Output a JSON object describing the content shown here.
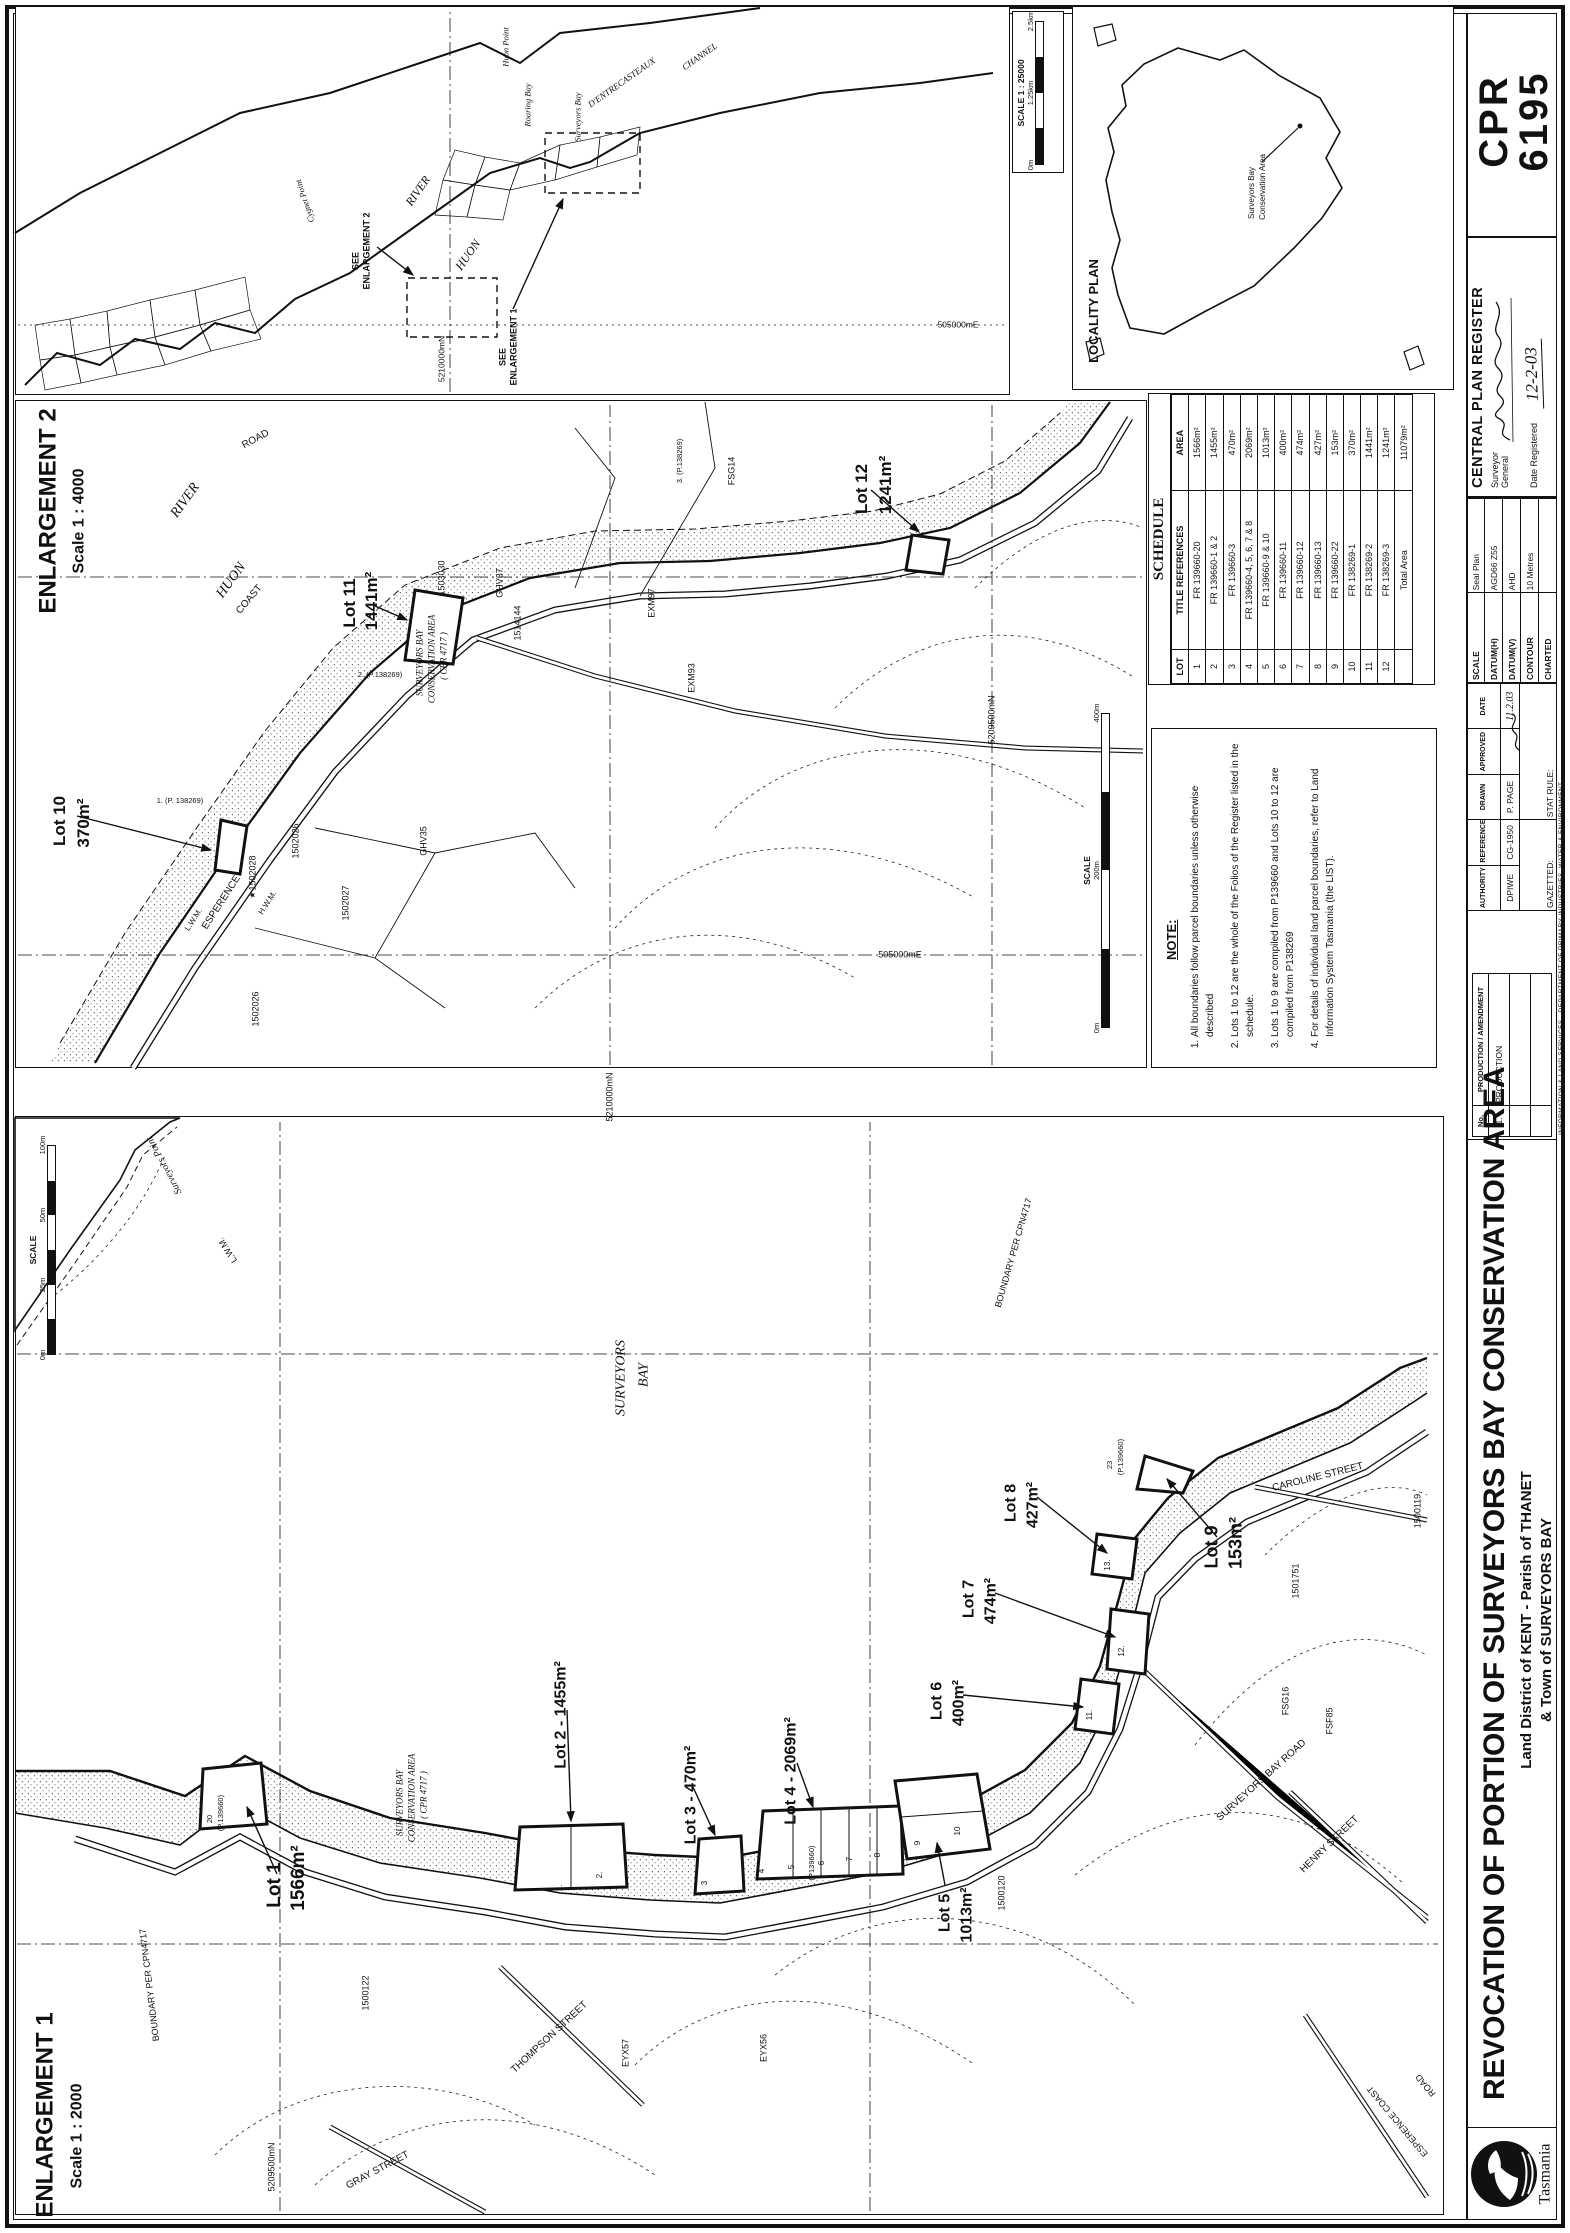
{
  "plan": {
    "cpr_line1": "CPR",
    "cpr_line2": "6195",
    "title": "REVOCATION OF PORTION OF  SURVEYORS BAY CONSERVATION AREA",
    "subtitle1": "Land District of KENT - Parish of THANET",
    "subtitle2": "& Town of SURVEYORS BAY",
    "logo_text": "Tasmania",
    "credit": "INFORMATION & LAND SERVICES  -  DEPARTMENT OF PRIMARY INDUSTRIES, WATER & ENVIRONMENT",
    "register": {
      "title": "CENTRAL PLAN REGISTER",
      "surveyor_line1": "Surveyor",
      "surveyor_line2": "General",
      "date_label": "Date Registered",
      "date_value": "12-2-03"
    },
    "datum_table": [
      [
        "SCALE",
        "Seal Plan"
      ],
      [
        "DATUM(H)",
        "AGD66 Z55"
      ],
      [
        "DATUM(V)",
        "AHD"
      ],
      [
        "CONTOUR",
        "10 Metres"
      ],
      [
        "CHARTED",
        ""
      ]
    ],
    "approvals": {
      "headers": [
        "AUTHORITY",
        "REFERENCE",
        "DRAWN",
        "APPROVED",
        "DATE"
      ],
      "values": [
        "DPIWE",
        "CG-1950",
        "P. PAGE",
        "",
        "11.2.03"
      ],
      "gazetted_label": "GAZETTED:",
      "stat_rule_label": "STAT RULE:"
    },
    "production": {
      "headers": [
        "No.",
        "PRODUCTION / AMENDMENT"
      ],
      "rows": [
        [
          "1.",
          "PRODUCTION"
        ],
        [
          "",
          ""
        ],
        [
          "",
          ""
        ]
      ]
    }
  },
  "schedule": {
    "title": "SCHEDULE",
    "headers": [
      "LOT",
      "TITLE REFERENCES",
      "AREA"
    ],
    "rows": [
      [
        "1",
        "FR 139660-20",
        "1566m²"
      ],
      [
        "2",
        "FR 139660-1 & 2",
        "1455m²"
      ],
      [
        "3",
        "FR 139660-3",
        "470m²"
      ],
      [
        "4",
        "FR 139660-4, 5, 6, 7 & 8",
        "2069m²"
      ],
      [
        "5",
        "FR 139660-9 & 10",
        "1013m²"
      ],
      [
        "6",
        "FR 139660-11",
        "400m²"
      ],
      [
        "7",
        "FR 139660-12",
        "474m²"
      ],
      [
        "8",
        "FR 139660-13",
        "427m²"
      ],
      [
        "9",
        "FR 139660-22",
        "153m²"
      ],
      [
        "10",
        "FR 138269-1",
        "370m²"
      ],
      [
        "11",
        "FR 138269-2",
        "1441m²"
      ],
      [
        "12",
        "FR 138269-3",
        "1241m²"
      ]
    ],
    "total_label": "Total Area",
    "total_value": "11079m²"
  },
  "notes": {
    "title": "NOTE:",
    "items": [
      "All boundaries follow parcel boundaries unless otherwise described",
      "Lots 1 to 12 are the whole of the Folios of the Register listed in the schedule.",
      "Lots 1 to 9 are compiled from P139660 and Lots 10 to 12 are compiled from P138269",
      "For details of individual land parcel boundaries, refer to Land Information System Tasmania (the LIST)."
    ]
  },
  "scalebars": [
    {
      "name": "enlargement1-scalebar",
      "x": 878,
      "y": 28,
      "w": 210,
      "label": "SCALE",
      "ticks": [
        "0m",
        "25m",
        "50m",
        "100m"
      ]
    },
    {
      "name": "enlargement2-scalebar",
      "x": 1205,
      "y": 1082,
      "w": 315,
      "label": "SCALE",
      "ticks": [
        "0m",
        "200m",
        "400m"
      ]
    },
    {
      "name": "overview-scalebar",
      "x": 2068,
      "y": 1016,
      "w": 144,
      "label": "SCALE 1 : 25000",
      "ticks": [
        "0m",
        "1.25km",
        "2.5km"
      ]
    }
  ],
  "map_labels": [
    {
      "t": "ENLARGEMENT 1",
      "x": 118,
      "y": 45,
      "fs": 24,
      "b": 1
    },
    {
      "t": "Scale 1 : 2000",
      "x": 97,
      "y": 78,
      "fs": 16,
      "b": 1
    },
    {
      "t": "Lot 1",
      "x": 348,
      "y": 275,
      "fs": 19,
      "b": 1
    },
    {
      "t": "1566m²",
      "x": 355,
      "y": 299,
      "fs": 19,
      "b": 1
    },
    {
      "t": "Lot 2 - 1455m²",
      "x": 518,
      "y": 562,
      "fs": 16,
      "b": 1
    },
    {
      "t": "Lot 3 - 470m²",
      "x": 438,
      "y": 692,
      "fs": 16,
      "b": 1
    },
    {
      "t": "Lot 4 - 2069m²",
      "x": 462,
      "y": 792,
      "fs": 16,
      "b": 1
    },
    {
      "t": "Lot 5",
      "x": 320,
      "y": 946,
      "fs": 16,
      "b": 1
    },
    {
      "t": "1013m²",
      "x": 318,
      "y": 968,
      "fs": 16,
      "b": 1
    },
    {
      "t": "Lot 6",
      "x": 532,
      "y": 938,
      "fs": 16,
      "b": 1
    },
    {
      "t": "400m²",
      "x": 530,
      "y": 960,
      "fs": 16,
      "b": 1
    },
    {
      "t": "Lot 7",
      "x": 634,
      "y": 970,
      "fs": 16,
      "b": 1
    },
    {
      "t": "474m²",
      "x": 632,
      "y": 992,
      "fs": 16,
      "b": 1
    },
    {
      "t": "Lot 8",
      "x": 730,
      "y": 1012,
      "fs": 16,
      "b": 1
    },
    {
      "t": "427m²",
      "x": 728,
      "y": 1034,
      "fs": 16,
      "b": 1
    },
    {
      "t": "Lot 9",
      "x": 686,
      "y": 1212,
      "fs": 18,
      "b": 1
    },
    {
      "t": "153m²",
      "x": 690,
      "y": 1236,
      "fs": 18,
      "b": 1
    },
    {
      "t": "SURVEYORS",
      "x": 855,
      "y": 622,
      "fs": 14,
      "i": 1
    },
    {
      "t": "BAY",
      "x": 858,
      "y": 645,
      "fs": 14,
      "i": 1
    },
    {
      "t": "Surveyors Point",
      "x": 1068,
      "y": 165,
      "fs": 10,
      "i": 1,
      "r": -28
    },
    {
      "t": "L.W.M.",
      "x": 983,
      "y": 228,
      "fs": 9,
      "r": -32
    },
    {
      "t": "BOUNDARY PER CPN4717",
      "x": 980,
      "y": 1014,
      "fs": 9,
      "r": 16
    },
    {
      "t": "BOUNDARY PER CPN4717",
      "x": 248,
      "y": 150,
      "fs": 9,
      "r": -7
    },
    {
      "t": "GRAY  STREET",
      "x": 62,
      "y": 378,
      "fs": 10,
      "r": 62
    },
    {
      "t": "THOMPSON  STREET",
      "x": 195,
      "y": 550,
      "fs": 10,
      "r": 47
    },
    {
      "t": "HENRY  STREET",
      "x": 388,
      "y": 1330,
      "fs": 10,
      "r": 46
    },
    {
      "t": "CAROLINE  STREET",
      "x": 755,
      "y": 1318,
      "fs": 10,
      "r": 76
    },
    {
      "t": "SURVEYORS  BAY  ROAD",
      "x": 452,
      "y": 1262,
      "fs": 10,
      "r": 48
    },
    {
      "t": "ESPERENCE COAST",
      "x": 112,
      "y": 1398,
      "fs": 9,
      "r": -40
    },
    {
      "t": "ROAD",
      "x": 148,
      "y": 1426,
      "fs": 9,
      "r": -40
    },
    {
      "t": "1500122",
      "x": 240,
      "y": 366,
      "fs": 9
    },
    {
      "t": "EYX57",
      "x": 180,
      "y": 626,
      "fs": 9
    },
    {
      "t": "EYX56",
      "x": 185,
      "y": 764,
      "fs": 9
    },
    {
      "t": "1500120",
      "x": 340,
      "y": 1002,
      "fs": 9
    },
    {
      "t": "1501751",
      "x": 652,
      "y": 1296,
      "fs": 9
    },
    {
      "t": "FSG16",
      "x": 532,
      "y": 1286,
      "fs": 9
    },
    {
      "t": "FSF85",
      "x": 512,
      "y": 1330,
      "fs": 9
    },
    {
      "t": "1500119",
      "x": 722,
      "y": 1418,
      "fs": 9
    },
    {
      "t": "SURVEYORS BAY",
      "x": 430,
      "y": 400,
      "fs": 9,
      "i": 1
    },
    {
      "t": "CONSERVATION AREA",
      "x": 435,
      "y": 412,
      "fs": 9,
      "i": 1
    },
    {
      "t": "( CPR 4717 )",
      "x": 438,
      "y": 424,
      "fs": 9,
      "i": 1
    },
    {
      "t": "23",
      "x": 768,
      "y": 1110,
      "fs": 7.5
    },
    {
      "t": "(P.139660)",
      "x": 776,
      "y": 1121,
      "fs": 7.5
    },
    {
      "t": "20",
      "x": 414,
      "y": 210,
      "fs": 7.5
    },
    {
      "t": "(P.139660)",
      "x": 420,
      "y": 221,
      "fs": 7.5
    },
    {
      "t": "(P139660)",
      "x": 370,
      "y": 812,
      "fs": 7.5
    },
    {
      "t": "5209500mN",
      "x": 66,
      "y": 272,
      "fs": 9
    },
    {
      "t": "1.",
      "x": 345,
      "y": 560,
      "fs": 8
    },
    {
      "t": "2.",
      "x": 358,
      "y": 600,
      "fs": 8
    },
    {
      "t": "3",
      "x": 350,
      "y": 705,
      "fs": 8
    },
    {
      "t": "4",
      "x": 362,
      "y": 762,
      "fs": 8
    },
    {
      "t": "5",
      "x": 366,
      "y": 792,
      "fs": 8
    },
    {
      "t": "6",
      "x": 370,
      "y": 822,
      "fs": 8
    },
    {
      "t": "7",
      "x": 374,
      "y": 850,
      "fs": 8
    },
    {
      "t": "8",
      "x": 378,
      "y": 878,
      "fs": 8
    },
    {
      "t": "9",
      "x": 390,
      "y": 918,
      "fs": 8
    },
    {
      "t": "10",
      "x": 402,
      "y": 958,
      "fs": 8
    },
    {
      "t": "11.",
      "x": 518,
      "y": 1090,
      "fs": 8
    },
    {
      "t": "12.",
      "x": 582,
      "y": 1122,
      "fs": 8
    },
    {
      "t": "13.",
      "x": 668,
      "y": 1108,
      "fs": 8
    },
    {
      "t": "ENLARGEMENT 2",
      "x": 1722,
      "y": 48,
      "fs": 24,
      "b": 1
    },
    {
      "t": "Scale 1 : 4000",
      "x": 1712,
      "y": 80,
      "fs": 16,
      "b": 1
    },
    {
      "t": "HUON",
      "x": 1652,
      "y": 232,
      "fs": 14,
      "i": 1,
      "r": 36
    },
    {
      "t": "RIVER",
      "x": 1732,
      "y": 186,
      "fs": 14,
      "i": 1,
      "r": 36
    },
    {
      "t": "Lot 11",
      "x": 1630,
      "y": 350,
      "fs": 17,
      "b": 1
    },
    {
      "t": "1441m²",
      "x": 1632,
      "y": 372,
      "fs": 17,
      "b": 1
    },
    {
      "t": "Lot 10",
      "x": 1412,
      "y": 60,
      "fs": 17,
      "b": 1
    },
    {
      "t": "370m²",
      "x": 1410,
      "y": 84,
      "fs": 17,
      "b": 1
    },
    {
      "t": "Lot 12",
      "x": 1744,
      "y": 862,
      "fs": 17,
      "b": 1
    },
    {
      "t": "1241m²",
      "x": 1748,
      "y": 886,
      "fs": 17,
      "b": 1
    },
    {
      "t": "SURVEYORS BAY",
      "x": 1570,
      "y": 420,
      "fs": 9,
      "i": 1
    },
    {
      "t": "CONSERVATION AREA",
      "x": 1574,
      "y": 432,
      "fs": 9,
      "i": 1
    },
    {
      "t": "( CPR 4717 )",
      "x": 1577,
      "y": 444,
      "fs": 9,
      "i": 1
    },
    {
      "t": "ESPERENCE",
      "x": 1330,
      "y": 222,
      "fs": 10,
      "r": 33
    },
    {
      "t": "COAST",
      "x": 1633,
      "y": 250,
      "fs": 10,
      "r": 40
    },
    {
      "t": "ROAD",
      "x": 1793,
      "y": 256,
      "fs": 10,
      "r": 62
    },
    {
      "t": "L.W.M.",
      "x": 1313,
      "y": 194,
      "fs": 8,
      "r": 33
    },
    {
      "t": "H.W.M.",
      "x": 1330,
      "y": 268,
      "fs": 8,
      "r": 33
    },
    {
      "t": "1. (P. 138269)",
      "x": 1432,
      "y": 180,
      "fs": 7.5,
      "r": 90
    },
    {
      "t": "2. (P.138269)",
      "x": 1558,
      "y": 380,
      "fs": 7.5,
      "r": 90
    },
    {
      "t": "3. (P.138269)",
      "x": 1772,
      "y": 680,
      "fs": 7.5
    },
    {
      "t": "★",
      "x": 1338,
      "y": 253,
      "fs": 8
    },
    {
      "t": "1502028",
      "x": 1360,
      "y": 253,
      "fs": 9
    },
    {
      "t": "1502026",
      "x": 1392,
      "y": 296,
      "fs": 9
    },
    {
      "t": "1502027",
      "x": 1330,
      "y": 346,
      "fs": 9
    },
    {
      "t": "1502026",
      "x": 1224,
      "y": 256,
      "fs": 9
    },
    {
      "t": "GHV35",
      "x": 1392,
      "y": 424,
      "fs": 9
    },
    {
      "t": "GHV37",
      "x": 1650,
      "y": 500,
      "fs": 9
    },
    {
      "t": "1503030",
      "x": 1655,
      "y": 442,
      "fs": 9
    },
    {
      "t": "1514144",
      "x": 1610,
      "y": 518,
      "fs": 9
    },
    {
      "t": "EXM97",
      "x": 1630,
      "y": 652,
      "fs": 9
    },
    {
      "t": "EXM93",
      "x": 1555,
      "y": 692,
      "fs": 9
    },
    {
      "t": "FSG14",
      "x": 1762,
      "y": 732,
      "fs": 9
    },
    {
      "t": "5210000mN",
      "x": 1136,
      "y": 610,
      "fs": 9
    },
    {
      "t": "5209500mN",
      "x": 1513,
      "y": 992,
      "fs": 9
    },
    {
      "t": "505000mE",
      "x": 1278,
      "y": 900,
      "fs": 9,
      "r": 90
    },
    {
      "t": "HUON",
      "x": 1978,
      "y": 468,
      "fs": 12,
      "i": 1,
      "r": 35
    },
    {
      "t": "RIVER",
      "x": 2042,
      "y": 418,
      "fs": 12,
      "i": 1,
      "r": 35
    },
    {
      "t": "Cygnet Point",
      "x": 2032,
      "y": 305,
      "fs": 8.5,
      "i": 1,
      "r": -18
    },
    {
      "t": "SEE",
      "x": 1876,
      "y": 503,
      "fs": 9,
      "b": 1
    },
    {
      "t": "ENLARGEMENT 1",
      "x": 1886,
      "y": 514,
      "fs": 9,
      "b": 1
    },
    {
      "t": "SEE",
      "x": 1972,
      "y": 356,
      "fs": 9,
      "b": 1
    },
    {
      "t": "ENLARGEMENT 2",
      "x": 1982,
      "y": 367,
      "fs": 9,
      "b": 1
    },
    {
      "t": "Surveyors Bay",
      "x": 2116,
      "y": 578,
      "fs": 8.5,
      "i": 1
    },
    {
      "t": "Huon Point",
      "x": 2186,
      "y": 506,
      "fs": 8.5,
      "i": 1
    },
    {
      "t": "Roaring Bay",
      "x": 2128,
      "y": 528,
      "fs": 8.5,
      "i": 1
    },
    {
      "t": "D'ENTRECASTEAUX",
      "x": 2150,
      "y": 622,
      "fs": 9,
      "i": 1,
      "r": 55
    },
    {
      "t": "CHANNEL",
      "x": 2176,
      "y": 700,
      "fs": 9,
      "i": 1,
      "r": 55
    },
    {
      "t": "5210000mN",
      "x": 1874,
      "y": 442,
      "fs": 8.5
    },
    {
      "t": "505000mE",
      "x": 1908,
      "y": 958,
      "fs": 8.5,
      "r": 90
    },
    {
      "t": "LOCALITY PLAN",
      "x": 1922,
      "y": 1094,
      "fs": 13,
      "b": 1
    },
    {
      "t": "Surveyors Bay",
      "x": 2040,
      "y": 1252,
      "fs": 8
    },
    {
      "t": "Conservation Area",
      "x": 2046,
      "y": 1263,
      "fs": 8
    }
  ]
}
